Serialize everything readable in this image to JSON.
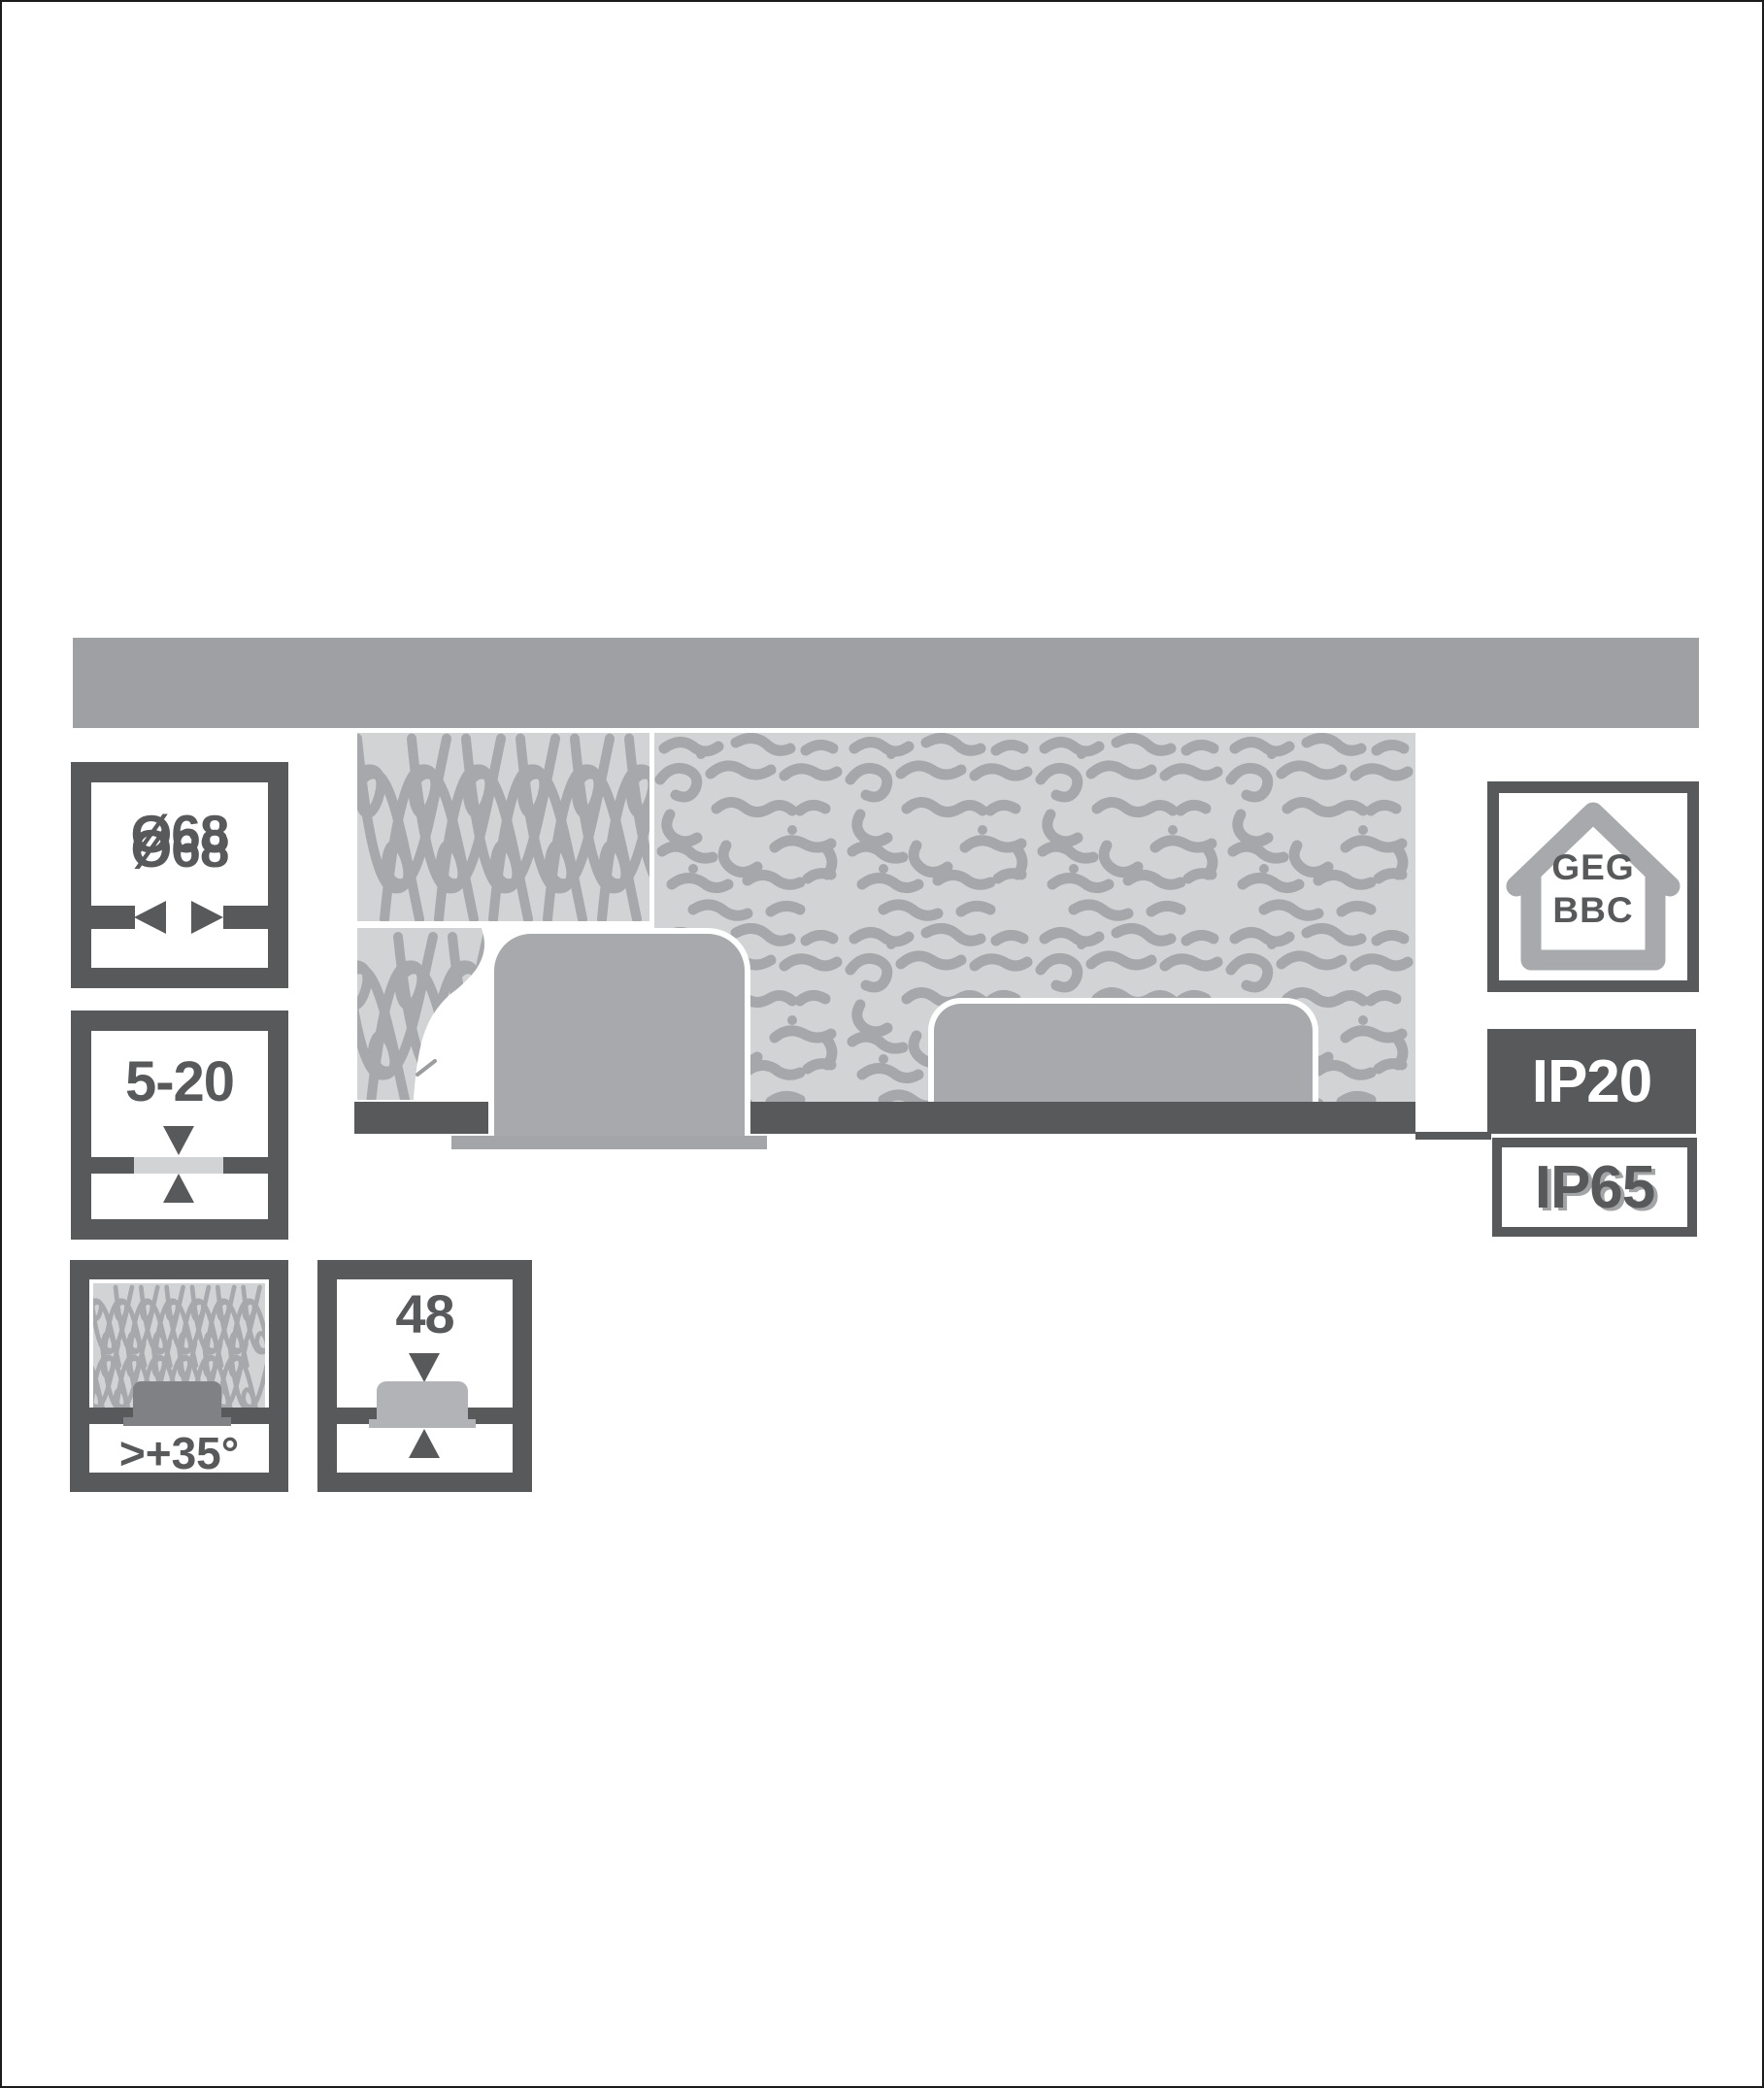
{
  "figure": {
    "description_labels": {
      "cutout": {
        "label": "Ø68"
      },
      "thickness": {
        "label": "5-20"
      },
      "insulation": {
        "label": ">+35°"
      },
      "depth": {
        "label": "48"
      },
      "codes": {
        "line1": "GEG",
        "line2": "BBC"
      },
      "ip_top": {
        "label": "IP20"
      },
      "ip_bottom": {
        "label": "IP65"
      }
    }
  },
  "icons": {
    "arrow_left": "◀",
    "arrow_right": "▶",
    "arrow_down": "▼",
    "arrow_up": "▲",
    "house": "house-outline",
    "insulation_loops": "coil-pattern",
    "insulation_maze": "maze-pattern"
  },
  "colors": {
    "outline_dark": "#58595b",
    "mid_gray": "#a7a9ac",
    "slab_gray": "#9ea0a3",
    "light_gray": "#d2d3d5",
    "silhouette_gray": "#7f8184",
    "fixture_light_gray": "#b1b3b6",
    "white": "#ffffff"
  }
}
